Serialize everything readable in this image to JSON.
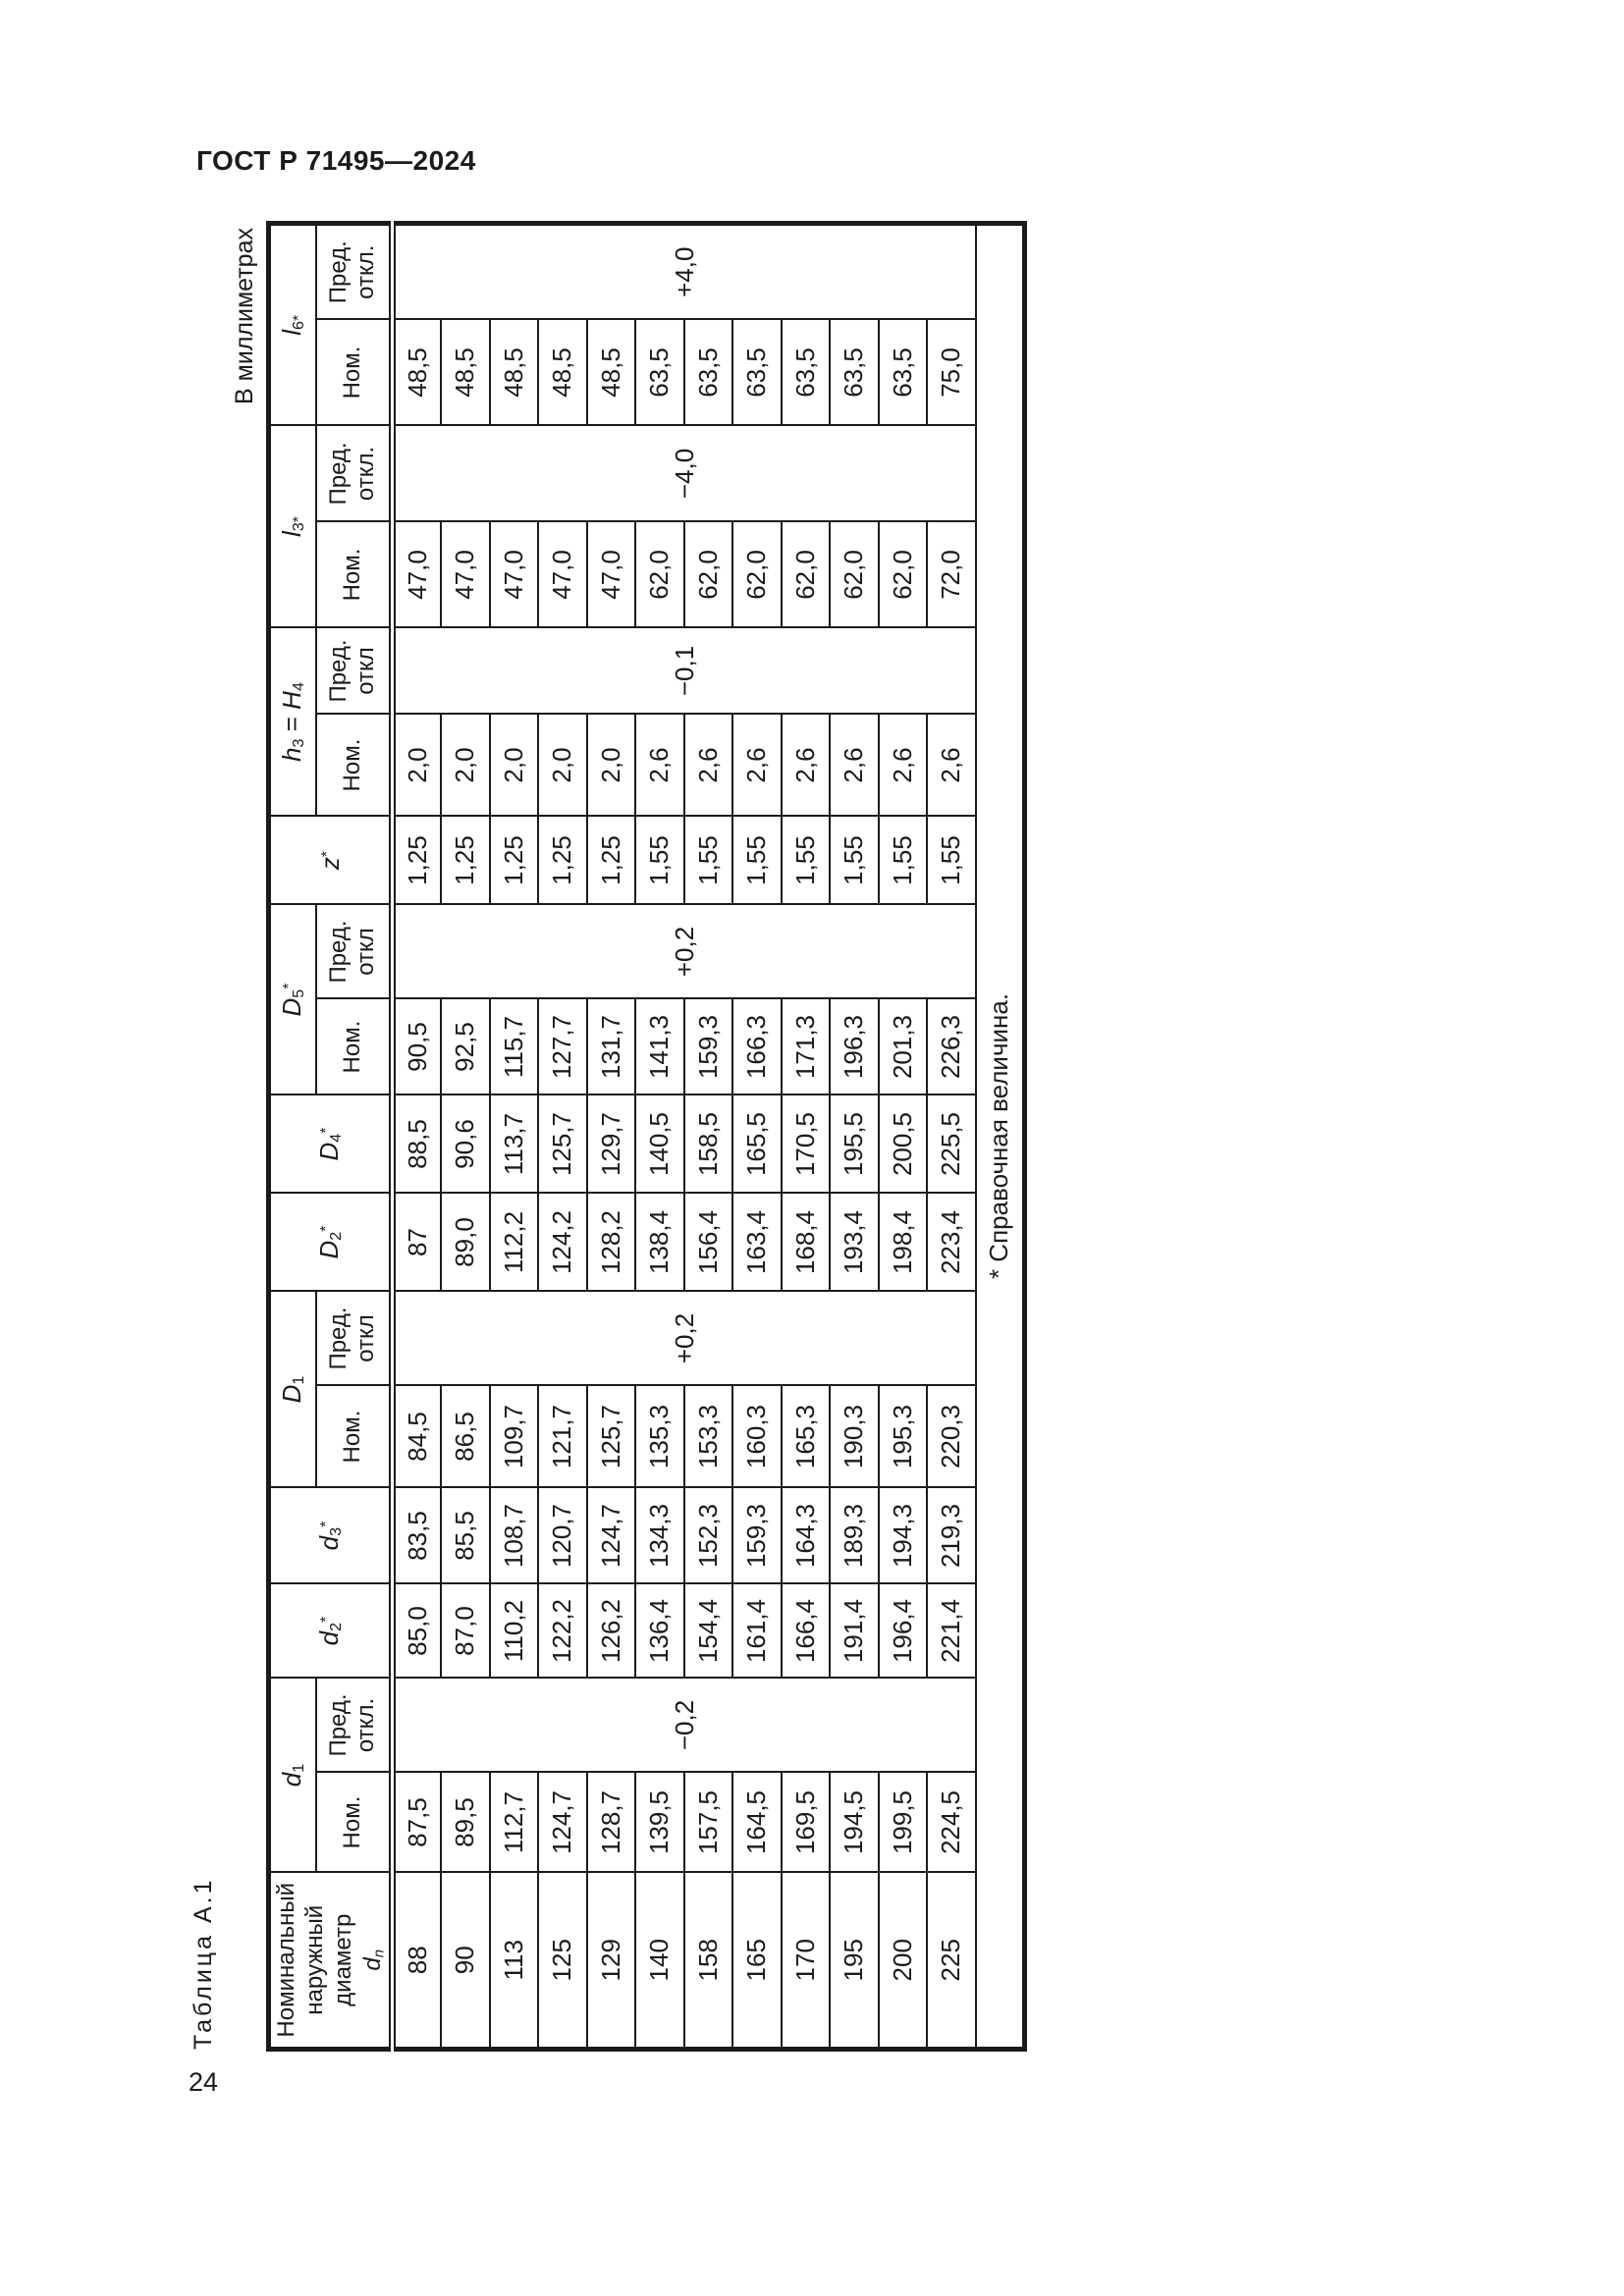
{
  "page": {
    "header": "ГОСТ Р 71495—2024",
    "page_number": "24",
    "table_caption": "Таблица А.1",
    "units_note": "В миллиметрах"
  },
  "table": {
    "row_count": 12,
    "footnote": "* Справочная величина.",
    "groups": [
      {
        "id": "dn",
        "label": "Номинальный\nнаружный\nдиаметр\nd_{n}",
        "type": "single",
        "values": [
          "88",
          "90",
          "113",
          "125",
          "129",
          "140",
          "158",
          "165",
          "170",
          "195",
          "200",
          "225"
        ]
      },
      {
        "id": "d1",
        "label": "d_{1}",
        "type": "pair",
        "nom_label": "Ном.",
        "pred_label": "Пред.\nоткл.",
        "nom_values": [
          "87,5",
          "89,5",
          "112,7",
          "124,7",
          "128,7",
          "139,5",
          "157,5",
          "164,5",
          "169,5",
          "194,5",
          "199,5",
          "224,5"
        ],
        "pred_value": "−0,2"
      },
      {
        "id": "d2",
        "label": "d_{2}^{*}",
        "type": "single",
        "values": [
          "85,0",
          "87,0",
          "110,2",
          "122,2",
          "126,2",
          "136,4",
          "154,4",
          "161,4",
          "166,4",
          "191,4",
          "196,4",
          "221,4"
        ]
      },
      {
        "id": "d3",
        "label": "d_{3}^{*}",
        "type": "single",
        "values": [
          "83,5",
          "85,5",
          "108,7",
          "120,7",
          "124,7",
          "134,3",
          "152,3",
          "159,3",
          "164,3",
          "189,3",
          "194,3",
          "219,3"
        ]
      },
      {
        "id": "D1",
        "label": "D_{1}",
        "type": "pair",
        "nom_label": "Ном.",
        "pred_label": "Пред.\nоткл",
        "nom_values": [
          "84,5",
          "86,5",
          "109,7",
          "121,7",
          "125,7",
          "135,3",
          "153,3",
          "160,3",
          "165,3",
          "190,3",
          "195,3",
          "220,3"
        ],
        "pred_value": "+0,2"
      },
      {
        "id": "D2",
        "label": "D_{2}^{*}",
        "type": "single",
        "values": [
          "87",
          "89,0",
          "112,2",
          "124,2",
          "128,2",
          "138,4",
          "156,4",
          "163,4",
          "168,4",
          "193,4",
          "198,4",
          "223,4"
        ]
      },
      {
        "id": "D4",
        "label": "D_{4}^{*}",
        "type": "single",
        "values": [
          "88,5",
          "90,6",
          "113,7",
          "125,7",
          "129,7",
          "140,5",
          "158,5",
          "165,5",
          "170,5",
          "195,5",
          "200,5",
          "225,5"
        ]
      },
      {
        "id": "D5",
        "label": "D_{5}^{*}",
        "type": "pair",
        "nom_label": "Ном.",
        "pred_label": "Пред.\nоткл",
        "nom_values": [
          "90,5",
          "92,5",
          "115,7",
          "127,7",
          "131,7",
          "141,3",
          "159,3",
          "166,3",
          "171,3",
          "196,3",
          "201,3",
          "226,3"
        ],
        "pred_value": "+0,2"
      },
      {
        "id": "z",
        "label": "z^{*}",
        "type": "single",
        "values": [
          "1,25",
          "1,25",
          "1,25",
          "1,25",
          "1,25",
          "1,55",
          "1,55",
          "1,55",
          "1,55",
          "1,55",
          "1,55",
          "1,55"
        ]
      },
      {
        "id": "h3",
        "label": "h_{3} = H_{4}",
        "type": "pair",
        "nom_label": "Ном.",
        "pred_label": "Пред.\nоткл",
        "nom_values": [
          "2,0",
          "2,0",
          "2,0",
          "2,0",
          "2,0",
          "2,6",
          "2,6",
          "2,6",
          "2,6",
          "2,6",
          "2,6",
          "2,6"
        ],
        "pred_value": "−0,1"
      },
      {
        "id": "l3",
        "label": "l_{3*}",
        "type": "pair",
        "nom_label": "Ном.",
        "pred_label": "Пред.\nоткл.",
        "nom_values": [
          "47,0",
          "47,0",
          "47,0",
          "47,0",
          "47,0",
          "62,0",
          "62,0",
          "62,0",
          "62,0",
          "62,0",
          "62,0",
          "72,0"
        ],
        "pred_value": "−4,0"
      },
      {
        "id": "l6",
        "label": "l_{6*}",
        "type": "pair",
        "nom_label": "Ном.",
        "pred_label": "Пред.\nоткл.",
        "nom_values": [
          "48,5",
          "48,5",
          "48,5",
          "48,5",
          "48,5",
          "63,5",
          "63,5",
          "63,5",
          "63,5",
          "63,5",
          "63,5",
          "75,0"
        ],
        "pred_value": "+4,0"
      }
    ]
  }
}
